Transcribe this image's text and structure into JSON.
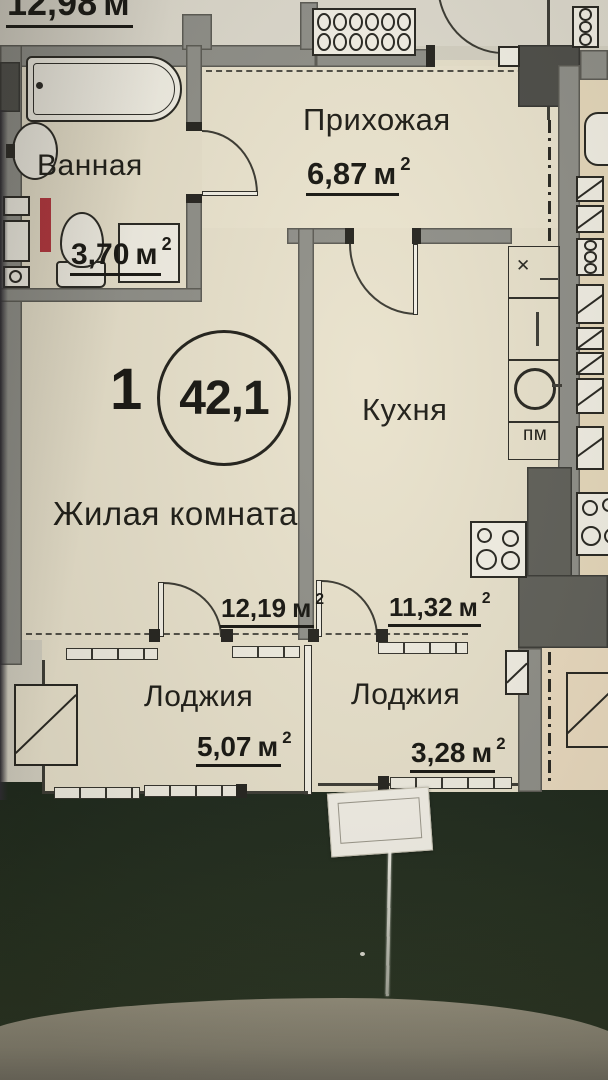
{
  "plan": {
    "unit": {
      "rooms_count": "1",
      "total_area": "42,1"
    },
    "area_unit": "м",
    "area_sup": "2",
    "rooms": [
      {
        "id": "bathroom",
        "name": "Ванная",
        "area": "3,70"
      },
      {
        "id": "hallway",
        "name": "Прихожая",
        "area": "6,87"
      },
      {
        "id": "kitchen",
        "name": "Кухня",
        "area": "11,32"
      },
      {
        "id": "living-room",
        "name": "Жилая комната",
        "area": "12,19"
      },
      {
        "id": "loggia-left",
        "name": "Лоджия",
        "area": "5,07"
      },
      {
        "id": "loggia-right",
        "name": "Лоджия",
        "area": "3,28"
      }
    ],
    "cropped_top_label": {
      "area": "12,98"
    },
    "appliance_labels": {
      "dishwasher": "пм"
    }
  },
  "colors": {
    "paper": "#d6d2c3",
    "room_fill": "#e9e2cc",
    "wall_gray": "#8f8f88",
    "dark_wall": "#4c4c47",
    "riser_red": "#b5323a",
    "background_green": "#222d1c",
    "table_edge": "#8a8573"
  }
}
